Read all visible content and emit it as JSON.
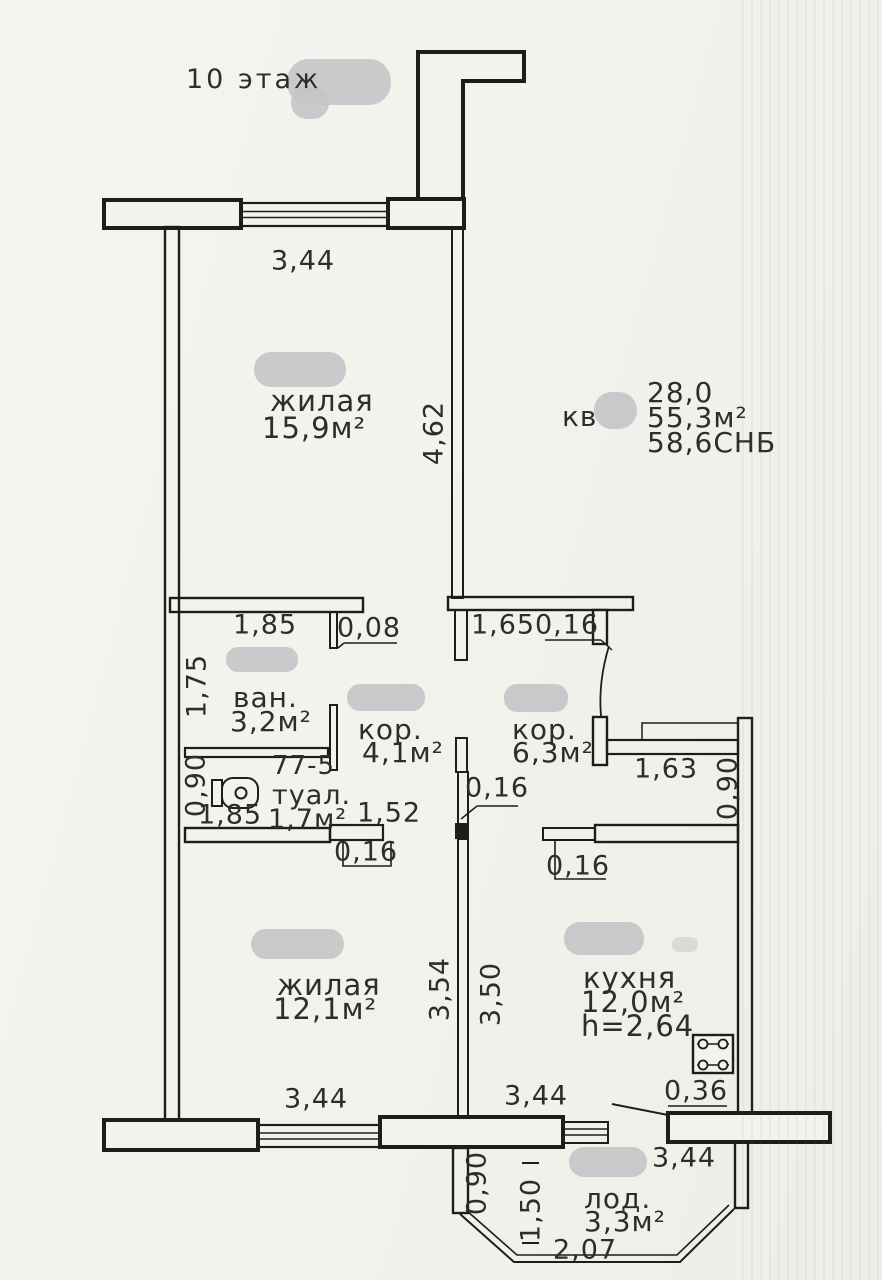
{
  "title": {
    "floor": "10 этаж"
  },
  "info": {
    "prefix": "кв",
    "living": "28,0",
    "total": "55,3м²",
    "snb": "58,6СНБ"
  },
  "marks": {
    "unit": "77-5"
  },
  "rooms": {
    "living1": {
      "name": "жилая",
      "area": "15,9м²"
    },
    "bath": {
      "name": "ван.",
      "area": "3,2м²"
    },
    "hall1": {
      "name": "кор.",
      "area": "4,1м²"
    },
    "hall2": {
      "name": "кор.",
      "area": "6,3м²"
    },
    "wc": {
      "name": "туал.",
      "area": "1,7м²"
    },
    "living2": {
      "name": "жилая",
      "area": "12,1м²"
    },
    "kitchen": {
      "name": "кухня",
      "area": "12,0м²",
      "ceiling": "h=2,64"
    },
    "loggia": {
      "name": "лод.",
      "area": "3,3м²"
    }
  },
  "dims": {
    "window_top": "3,44",
    "living1_depth": "4,62",
    "bath_width": "1,85",
    "bath_jamb": "0,08",
    "hall_opening": "1,65",
    "hall_jamb": "0,16",
    "bath_depth": "1,75",
    "wc_depth": "0,90",
    "wc_width": "1,85",
    "wc_opening": "1,52",
    "wc_jamb": "0,16",
    "mid_wall": "0,16",
    "entry_width": "1,63",
    "entry_depth": "0,90",
    "kitchen_jamb": "0,16",
    "living2_depth": "3,54",
    "kitchen_depth": "3,50",
    "living2_window": "3,44",
    "hall_window": "3,44",
    "stove_gap": "0,36",
    "kitchen_wall": "3,44",
    "loggia_side": "0,90",
    "loggia_depth": "1,50",
    "loggia_width": "2,07"
  },
  "colors": {
    "paper": "#f4f2ed",
    "ink": "#1e1d1b",
    "text": "#2e2d2b",
    "redaction": "#c6c6c8"
  }
}
